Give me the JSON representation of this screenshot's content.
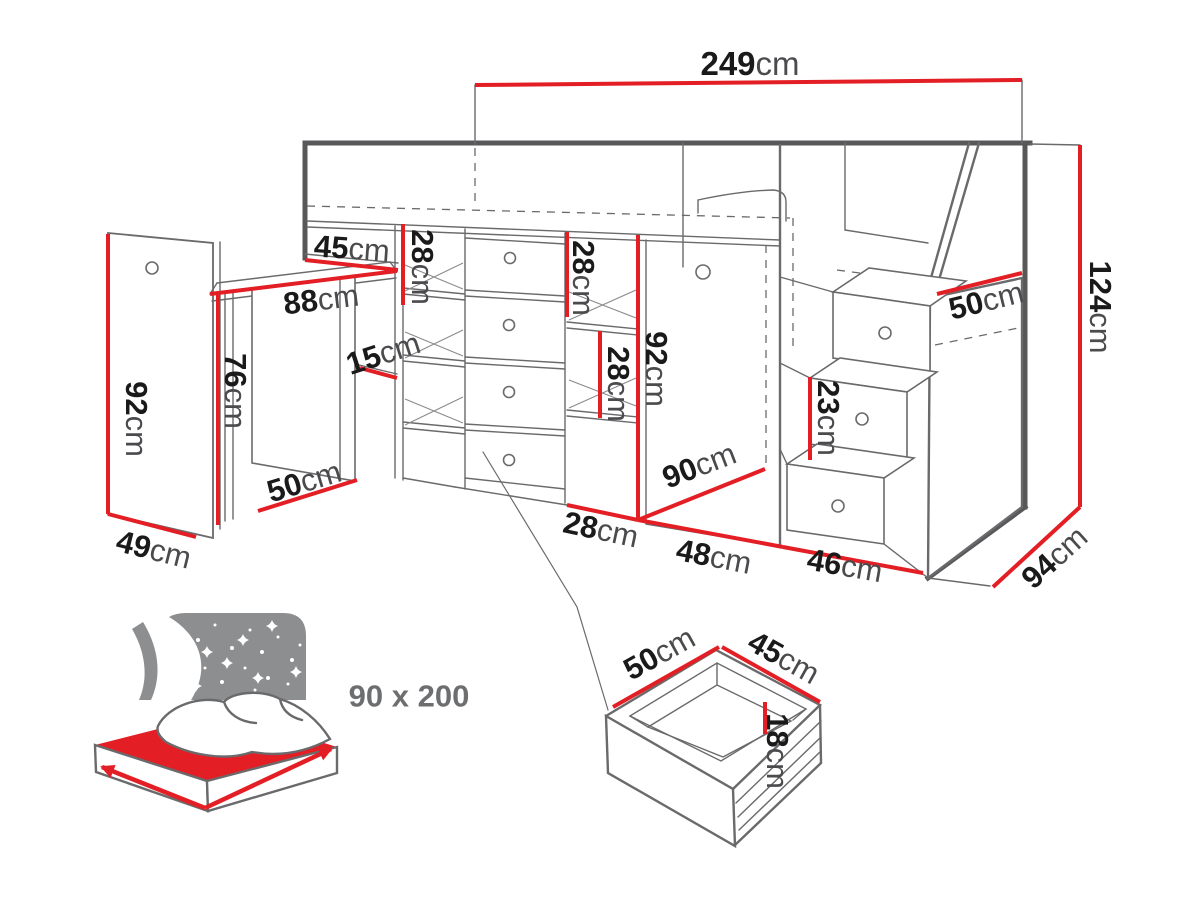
{
  "diagram_title": "loft-bed-dimension-diagram",
  "colors": {
    "dimension_red": "#e31e24",
    "number_black": "#1a1a1a",
    "unit_gray": "#4b4b4e",
    "line_gray": "#6a6a6c",
    "frame_gray": "#58585a",
    "icon_gray": "#8d8e90"
  },
  "dims": {
    "total_width": {
      "num": "249",
      "unit": "cm"
    },
    "total_height": {
      "num": "124",
      "unit": "cm"
    },
    "total_depth": {
      "num": "94",
      "unit": "cm"
    },
    "top_shelf_depth": {
      "num": "45",
      "unit": "cm"
    },
    "shelf_height_a": {
      "num": "28",
      "unit": "cm"
    },
    "desk_width": {
      "num": "88",
      "unit": "cm"
    },
    "shelf_clearance": {
      "num": "15",
      "unit": "cm"
    },
    "desk_height": {
      "num": "76",
      "unit": "cm"
    },
    "side_panel_height": {
      "num": "92",
      "unit": "cm"
    },
    "side_panel_depth": {
      "num": "49",
      "unit": "cm"
    },
    "desk_depth": {
      "num": "50",
      "unit": "cm"
    },
    "shelf_height_b": {
      "num": "28",
      "unit": "cm"
    },
    "shelf_height_c": {
      "num": "28",
      "unit": "cm"
    },
    "cabinet_height": {
      "num": "92",
      "unit": "cm"
    },
    "cabinet_depth": {
      "num": "90",
      "unit": "cm"
    },
    "drawer_section_width": {
      "num": "28",
      "unit": "cm"
    },
    "wardrobe_section_width": {
      "num": "48",
      "unit": "cm"
    },
    "stairs_width": {
      "num": "46",
      "unit": "cm"
    },
    "stairs_top_depth": {
      "num": "50",
      "unit": "cm"
    },
    "step_height": {
      "num": "23",
      "unit": "cm"
    },
    "drawer_depth": {
      "num": "50",
      "unit": "cm"
    },
    "drawer_width": {
      "num": "45",
      "unit": "cm"
    },
    "drawer_height": {
      "num": "18",
      "unit": "cm"
    }
  },
  "mattress": {
    "size_label": "90 x 200"
  }
}
